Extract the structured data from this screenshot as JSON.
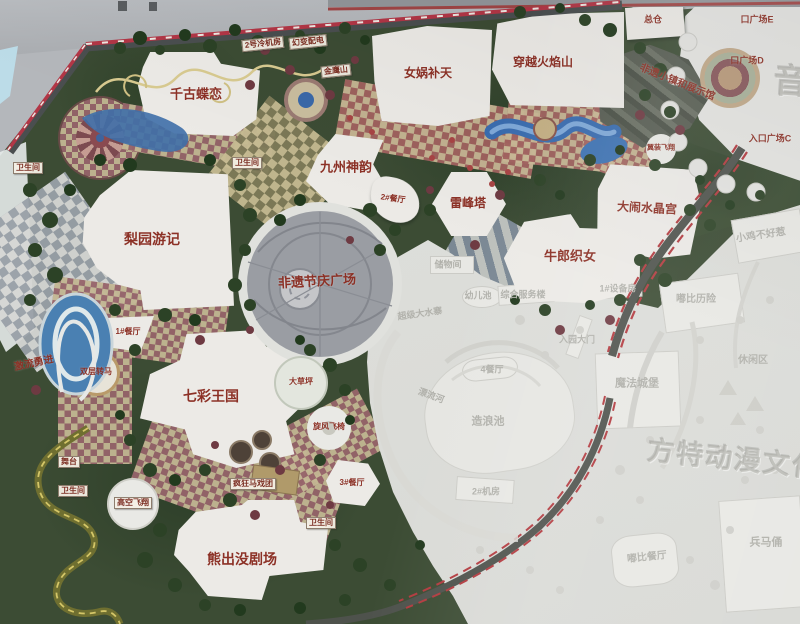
{
  "park": {
    "attraction_labels": [
      {
        "text": "千古蝶恋"
      },
      {
        "text": "女娲补天"
      },
      {
        "text": "穿越火焰山"
      },
      {
        "text": "九州神韵"
      },
      {
        "text": "雷峰塔"
      },
      {
        "text": "大闹水晶宫"
      },
      {
        "text": "牛郎织女"
      },
      {
        "text": "梨园游记"
      },
      {
        "text": "非遗节庆广场"
      },
      {
        "text": "七彩王国"
      },
      {
        "text": "熊出没剧场"
      },
      {
        "text": "激流勇进"
      },
      {
        "text": "非遗小镇和展示馆"
      },
      {
        "text": "总仓"
      }
    ],
    "facility_labels": [
      {
        "text": "卫生间"
      },
      {
        "text": "卫生间"
      },
      {
        "text": "2#餐厅"
      },
      {
        "text": "1#餐厅"
      },
      {
        "text": "双层转马"
      },
      {
        "text": "大草坪"
      },
      {
        "text": "旋风飞椅"
      },
      {
        "text": "疯狂马戏团"
      },
      {
        "text": "3#餐厅"
      },
      {
        "text": "卫生间"
      },
      {
        "text": "高空飞翔"
      },
      {
        "text": "舞台"
      },
      {
        "text": "卫生间"
      },
      {
        "text": "2号冷机房"
      },
      {
        "text": "幻变配电"
      },
      {
        "text": "金鹰山"
      },
      {
        "text": "翼装飞翔"
      }
    ],
    "entrance_labels": [
      {
        "text": "口广场E"
      },
      {
        "text": "口广场D"
      },
      {
        "text": "入口广场C"
      }
    ],
    "faded_labels": [
      {
        "text": "储物间"
      },
      {
        "text": "幼儿池"
      },
      {
        "text": "综合服务楼"
      },
      {
        "text": "1#设备房"
      },
      {
        "text": "超级大水寨"
      },
      {
        "text": "漂流河"
      },
      {
        "text": "造浪池"
      },
      {
        "text": "4餐厅"
      },
      {
        "text": "2#机房"
      },
      {
        "text": "入园大门"
      },
      {
        "text": "魔法城堡"
      },
      {
        "text": "嘟比历险"
      },
      {
        "text": "小鸡不好惹"
      },
      {
        "text": "休闲区"
      },
      {
        "text": "嘟比餐厅"
      },
      {
        "text": "兵马俑"
      }
    ],
    "watermarks": [
      {
        "text": "方特动漫文化科技"
      },
      {
        "text": "音乐"
      }
    ],
    "colors": {
      "label_red": "#8c3126",
      "stripe_red": "#b23646",
      "water_blue": "#3f74b4",
      "path_tan": "#c3b793",
      "path_maroon": "#96646a",
      "tree_green": "#2c4226",
      "faded_text": "#b1b1ab",
      "plaza_gray": "#9a9da3"
    }
  }
}
